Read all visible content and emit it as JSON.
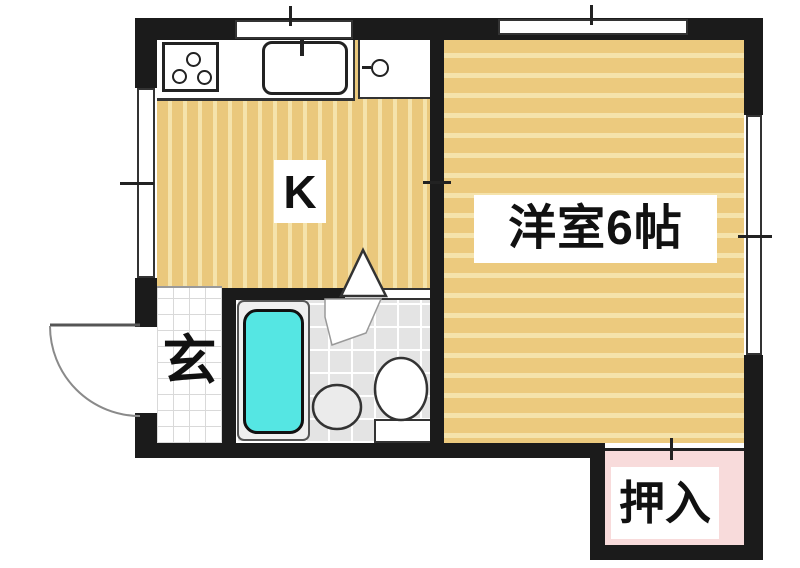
{
  "plan": {
    "kitchen_label": "K",
    "western_room_label": "洋室6帖",
    "entrance_label": "玄",
    "closet_label": "押入"
  },
  "fixtures": {
    "stove": "stove-3-burner-icon",
    "kitchen_sink": "sink-with-faucet-icon",
    "side_unit": "small-basin-unit-icon",
    "bathtub": "bathtub-icon",
    "wash_basin": "round-basin-icon",
    "toilet": "toilet-icon",
    "entrance_door": "swing-door-arc-icon",
    "bath_door": "folding-door-triangle-icon",
    "closet_door": "sliding-door-line-icon"
  },
  "colors": {
    "wall": "#1b1b1b",
    "floor_base": "#eac87c",
    "floor_stripe": "#f5e3ab",
    "bathtub": "#55e6e3",
    "bath_tile": "#e4e4e4",
    "closet_bg": "#f8dbdb",
    "genkan_tile": "#ffffff",
    "label_bg": "#ffffff",
    "text": "#111111"
  }
}
